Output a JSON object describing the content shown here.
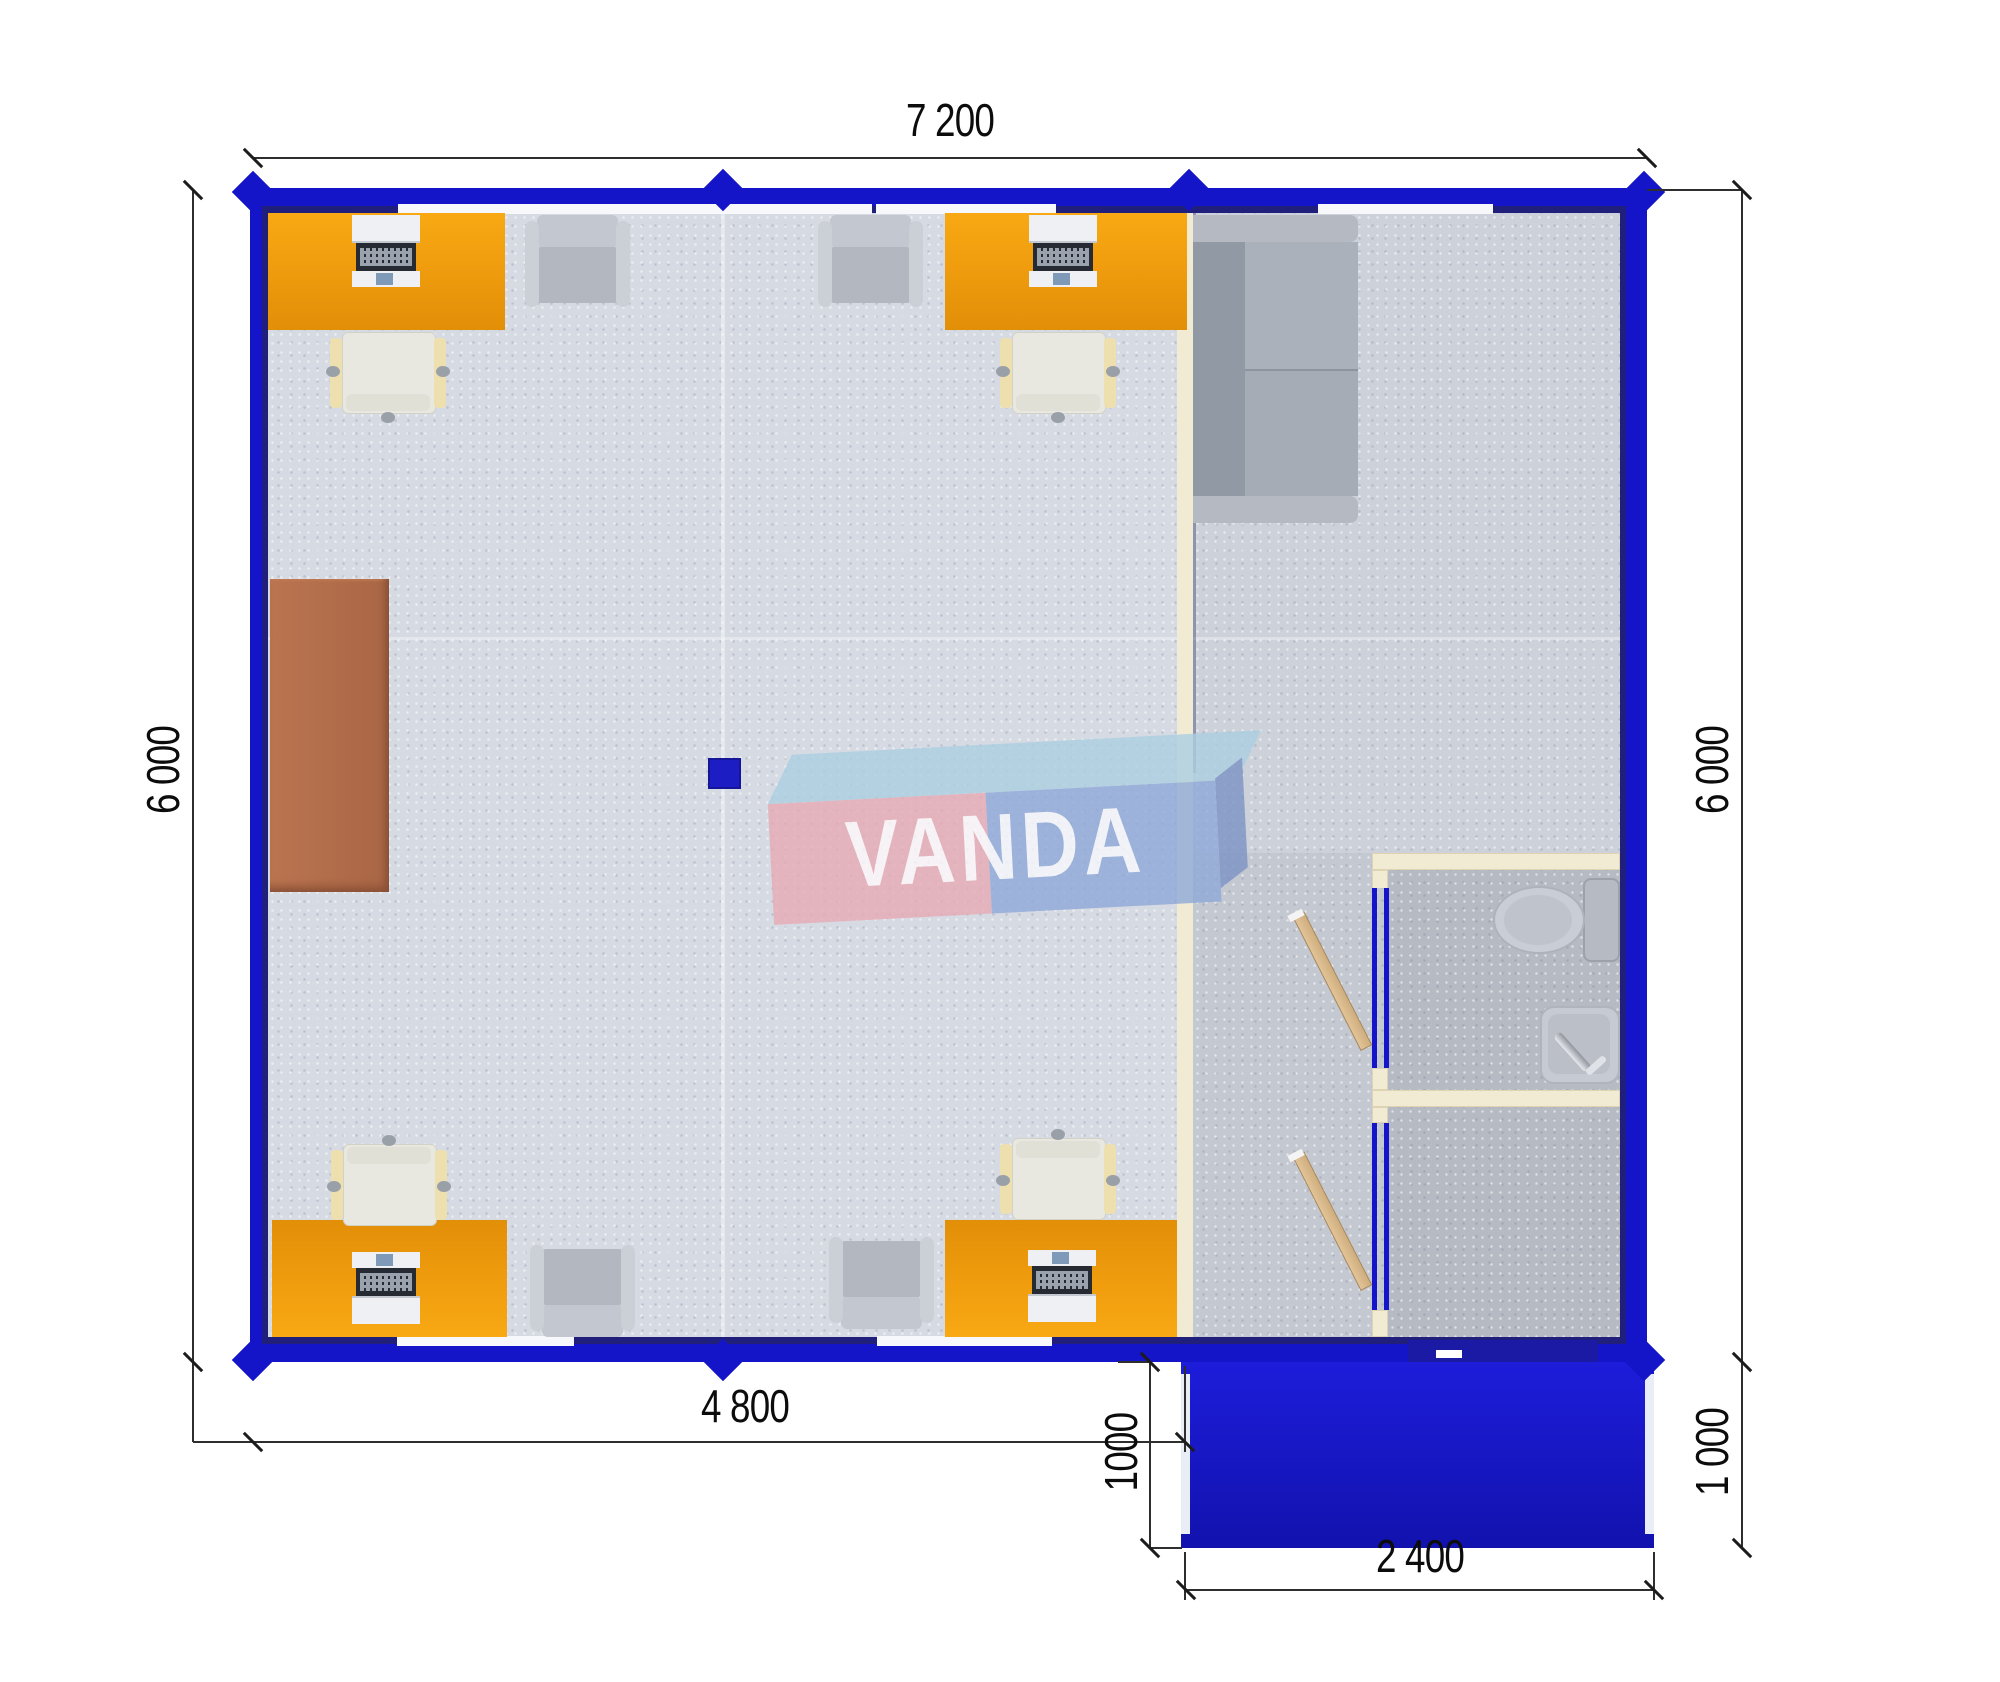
{
  "title": "modular-cabin-floor-plan",
  "brand": {
    "name": "VANDA"
  },
  "dimensions": {
    "top": "7 200",
    "left": "6 000",
    "right": "6 000",
    "bottom": "4 800",
    "porch_left": "1000",
    "porch_right": "1 000",
    "porch_bottom": "2 400"
  },
  "colors": {
    "wall_blue": "#1414c8",
    "wall_inner_navy": "#20207c",
    "desk_orange": "#ee9a0d",
    "cabinet_brown": "#b26e4e",
    "porch_blue": "#1b1bd4",
    "partition_cream": "#f2ebd3",
    "door_wood": "#d8b88b",
    "logo_pink": "#e8abb5",
    "logo_blue": "#8fa9d8",
    "logo_lightblue": "#accfe1",
    "floor_office": "#d6dae3",
    "floor_room": "#cdd1da",
    "floor_wet": "#b6bac3"
  },
  "rooms": [
    "office",
    "lounge",
    "corridor",
    "bathroom",
    "vestibule",
    "porch"
  ]
}
